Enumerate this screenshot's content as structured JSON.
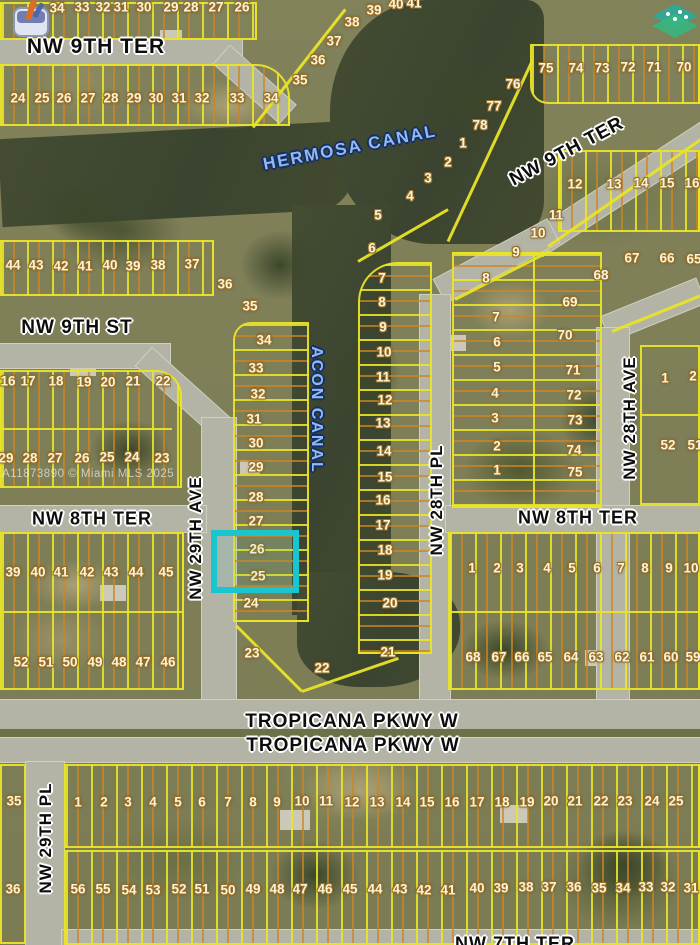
{
  "map": {
    "watermark": "A11873890 © Miami MLS 2025",
    "highlighted_lots": [
      "26",
      "25"
    ],
    "icons": [
      {
        "name": "listing-marker-icon"
      },
      {
        "name": "mls-logo-icon"
      }
    ],
    "street_labels": [
      {
        "text": "NW 9TH TER",
        "x": 96,
        "y": 47,
        "rot": 0,
        "size": 21,
        "canal": false
      },
      {
        "text": "NW 9TH TER",
        "x": 567,
        "y": 152,
        "rot": -28,
        "size": 19,
        "canal": false
      },
      {
        "text": "HERMOSA CANAL",
        "x": 350,
        "y": 148,
        "rot": -11,
        "size": 17,
        "canal": true
      },
      {
        "text": "NW 9TH ST",
        "x": 77,
        "y": 328,
        "rot": 0,
        "size": 19,
        "canal": false
      },
      {
        "text": "ACON CANAL",
        "x": 316,
        "y": 410,
        "rot": 90,
        "size": 16,
        "canal": true
      },
      {
        "text": "NW 29TH AVE",
        "x": 196,
        "y": 538,
        "rot": -90,
        "size": 17,
        "canal": false
      },
      {
        "text": "NW 28TH PL",
        "x": 437,
        "y": 500,
        "rot": -90,
        "size": 17,
        "canal": false
      },
      {
        "text": "NW 28TH AVE",
        "x": 630,
        "y": 418,
        "rot": -90,
        "size": 17,
        "canal": false
      },
      {
        "text": "NW 8TH TER",
        "x": 92,
        "y": 519,
        "rot": 0,
        "size": 18,
        "canal": false
      },
      {
        "text": "NW 8TH TER",
        "x": 578,
        "y": 518,
        "rot": 0,
        "size": 18,
        "canal": false
      },
      {
        "text": "TROPICANA PKWY W",
        "x": 352,
        "y": 722,
        "rot": 0,
        "size": 19,
        "canal": false
      },
      {
        "text": "TROPICANA PKWY W",
        "x": 353,
        "y": 746,
        "rot": 0,
        "size": 19,
        "canal": false
      },
      {
        "text": "NW 29TH PL",
        "x": 46,
        "y": 838,
        "rot": -90,
        "size": 17,
        "canal": false
      },
      {
        "text": "NW 7TH TER",
        "x": 515,
        "y": 944,
        "rot": 0,
        "size": 18,
        "canal": false
      }
    ],
    "lot_numbers": [
      {
        "t": "34",
        "x": 57,
        "y": 8
      },
      {
        "t": "33",
        "x": 82,
        "y": 7
      },
      {
        "t": "32",
        "x": 103,
        "y": 7
      },
      {
        "t": "31",
        "x": 121,
        "y": 7
      },
      {
        "t": "30",
        "x": 144,
        "y": 7
      },
      {
        "t": "29",
        "x": 171,
        "y": 7
      },
      {
        "t": "28",
        "x": 191,
        "y": 7
      },
      {
        "t": "27",
        "x": 216,
        "y": 7
      },
      {
        "t": "26",
        "x": 242,
        "y": 7
      },
      {
        "t": "24",
        "x": 18,
        "y": 98
      },
      {
        "t": "25",
        "x": 42,
        "y": 98
      },
      {
        "t": "26",
        "x": 64,
        "y": 98
      },
      {
        "t": "27",
        "x": 88,
        "y": 98
      },
      {
        "t": "28",
        "x": 111,
        "y": 98
      },
      {
        "t": "29",
        "x": 134,
        "y": 98
      },
      {
        "t": "30",
        "x": 156,
        "y": 98
      },
      {
        "t": "31",
        "x": 179,
        "y": 98
      },
      {
        "t": "32",
        "x": 202,
        "y": 98
      },
      {
        "t": "33",
        "x": 237,
        "y": 98
      },
      {
        "t": "34",
        "x": 271,
        "y": 98
      },
      {
        "t": "35",
        "x": 300,
        "y": 80
      },
      {
        "t": "36",
        "x": 318,
        "y": 60
      },
      {
        "t": "37",
        "x": 334,
        "y": 41
      },
      {
        "t": "38",
        "x": 352,
        "y": 22
      },
      {
        "t": "39",
        "x": 374,
        "y": 10
      },
      {
        "t": "40",
        "x": 396,
        "y": 4
      },
      {
        "t": "41",
        "x": 414,
        "y": 3
      },
      {
        "t": "75",
        "x": 546,
        "y": 68
      },
      {
        "t": "74",
        "x": 576,
        "y": 68
      },
      {
        "t": "73",
        "x": 602,
        "y": 68
      },
      {
        "t": "72",
        "x": 628,
        "y": 67
      },
      {
        "t": "71",
        "x": 654,
        "y": 67
      },
      {
        "t": "70",
        "x": 684,
        "y": 67
      },
      {
        "t": "76",
        "x": 513,
        "y": 84
      },
      {
        "t": "77",
        "x": 494,
        "y": 106
      },
      {
        "t": "78",
        "x": 480,
        "y": 125
      },
      {
        "t": "1",
        "x": 463,
        "y": 143
      },
      {
        "t": "2",
        "x": 448,
        "y": 162
      },
      {
        "t": "3",
        "x": 428,
        "y": 178
      },
      {
        "t": "4",
        "x": 410,
        "y": 196
      },
      {
        "t": "44",
        "x": 13,
        "y": 265
      },
      {
        "t": "43",
        "x": 36,
        "y": 265
      },
      {
        "t": "42",
        "x": 61,
        "y": 266
      },
      {
        "t": "41",
        "x": 85,
        "y": 266
      },
      {
        "t": "40",
        "x": 110,
        "y": 265
      },
      {
        "t": "39",
        "x": 133,
        "y": 266
      },
      {
        "t": "38",
        "x": 158,
        "y": 265
      },
      {
        "t": "37",
        "x": 192,
        "y": 264
      },
      {
        "t": "36",
        "x": 225,
        "y": 284
      },
      {
        "t": "35",
        "x": 250,
        "y": 306
      },
      {
        "t": "16",
        "x": 8,
        "y": 381
      },
      {
        "t": "17",
        "x": 28,
        "y": 381
      },
      {
        "t": "18",
        "x": 56,
        "y": 381
      },
      {
        "t": "19",
        "x": 84,
        "y": 382
      },
      {
        "t": "20",
        "x": 108,
        "y": 382
      },
      {
        "t": "21",
        "x": 133,
        "y": 381
      },
      {
        "t": "22",
        "x": 163,
        "y": 381
      },
      {
        "t": "29",
        "x": 6,
        "y": 458
      },
      {
        "t": "28",
        "x": 30,
        "y": 458
      },
      {
        "t": "27",
        "x": 55,
        "y": 458
      },
      {
        "t": "26",
        "x": 82,
        "y": 458
      },
      {
        "t": "25",
        "x": 107,
        "y": 457
      },
      {
        "t": "24",
        "x": 132,
        "y": 457
      },
      {
        "t": "23",
        "x": 162,
        "y": 458
      },
      {
        "t": "34",
        "x": 264,
        "y": 340
      },
      {
        "t": "33",
        "x": 256,
        "y": 368
      },
      {
        "t": "32",
        "x": 258,
        "y": 394
      },
      {
        "t": "31",
        "x": 254,
        "y": 419
      },
      {
        "t": "30",
        "x": 256,
        "y": 443
      },
      {
        "t": "29",
        "x": 256,
        "y": 467
      },
      {
        "t": "28",
        "x": 256,
        "y": 497
      },
      {
        "t": "27",
        "x": 256,
        "y": 521
      },
      {
        "t": "26",
        "x": 257,
        "y": 549
      },
      {
        "t": "25",
        "x": 258,
        "y": 576
      },
      {
        "t": "24",
        "x": 251,
        "y": 603
      },
      {
        "t": "23",
        "x": 252,
        "y": 653
      },
      {
        "t": "22",
        "x": 322,
        "y": 668
      },
      {
        "t": "5",
        "x": 378,
        "y": 215
      },
      {
        "t": "6",
        "x": 372,
        "y": 248
      },
      {
        "t": "7",
        "x": 382,
        "y": 278
      },
      {
        "t": "8",
        "x": 382,
        "y": 302
      },
      {
        "t": "9",
        "x": 383,
        "y": 327
      },
      {
        "t": "10",
        "x": 384,
        "y": 352
      },
      {
        "t": "11",
        "x": 383,
        "y": 377
      },
      {
        "t": "12",
        "x": 385,
        "y": 400
      },
      {
        "t": "13",
        "x": 383,
        "y": 423
      },
      {
        "t": "14",
        "x": 384,
        "y": 451
      },
      {
        "t": "15",
        "x": 385,
        "y": 477
      },
      {
        "t": "16",
        "x": 383,
        "y": 500
      },
      {
        "t": "17",
        "x": 383,
        "y": 525
      },
      {
        "t": "18",
        "x": 385,
        "y": 550
      },
      {
        "t": "19",
        "x": 385,
        "y": 575
      },
      {
        "t": "20",
        "x": 390,
        "y": 603
      },
      {
        "t": "21",
        "x": 388,
        "y": 652
      },
      {
        "t": "12",
        "x": 575,
        "y": 184
      },
      {
        "t": "13",
        "x": 614,
        "y": 184
      },
      {
        "t": "14",
        "x": 641,
        "y": 183
      },
      {
        "t": "15",
        "x": 667,
        "y": 183
      },
      {
        "t": "16",
        "x": 692,
        "y": 183
      },
      {
        "t": "11",
        "x": 556,
        "y": 215
      },
      {
        "t": "10",
        "x": 538,
        "y": 233
      },
      {
        "t": "9",
        "x": 516,
        "y": 252
      },
      {
        "t": "8",
        "x": 486,
        "y": 278
      },
      {
        "t": "7",
        "x": 496,
        "y": 317
      },
      {
        "t": "6",
        "x": 497,
        "y": 342
      },
      {
        "t": "5",
        "x": 497,
        "y": 367
      },
      {
        "t": "4",
        "x": 495,
        "y": 393
      },
      {
        "t": "3",
        "x": 495,
        "y": 418
      },
      {
        "t": "2",
        "x": 497,
        "y": 446
      },
      {
        "t": "1",
        "x": 497,
        "y": 470
      },
      {
        "t": "67",
        "x": 632,
        "y": 258
      },
      {
        "t": "66",
        "x": 667,
        "y": 258
      },
      {
        "t": "65",
        "x": 694,
        "y": 259
      },
      {
        "t": "68",
        "x": 601,
        "y": 275
      },
      {
        "t": "69",
        "x": 570,
        "y": 302
      },
      {
        "t": "70",
        "x": 565,
        "y": 335
      },
      {
        "t": "71",
        "x": 573,
        "y": 370
      },
      {
        "t": "72",
        "x": 574,
        "y": 395
      },
      {
        "t": "73",
        "x": 575,
        "y": 420
      },
      {
        "t": "74",
        "x": 574,
        "y": 450
      },
      {
        "t": "75",
        "x": 575,
        "y": 472
      },
      {
        "t": "1",
        "x": 665,
        "y": 378
      },
      {
        "t": "2",
        "x": 693,
        "y": 376
      },
      {
        "t": "52",
        "x": 668,
        "y": 445
      },
      {
        "t": "51",
        "x": 695,
        "y": 445
      },
      {
        "t": "1",
        "x": 472,
        "y": 568
      },
      {
        "t": "2",
        "x": 497,
        "y": 568
      },
      {
        "t": "3",
        "x": 520,
        "y": 568
      },
      {
        "t": "4",
        "x": 547,
        "y": 568
      },
      {
        "t": "5",
        "x": 572,
        "y": 568
      },
      {
        "t": "6",
        "x": 597,
        "y": 568
      },
      {
        "t": "7",
        "x": 621,
        "y": 568
      },
      {
        "t": "8",
        "x": 645,
        "y": 568
      },
      {
        "t": "9",
        "x": 669,
        "y": 568
      },
      {
        "t": "10",
        "x": 691,
        "y": 568
      },
      {
        "t": "68",
        "x": 473,
        "y": 657
      },
      {
        "t": "67",
        "x": 499,
        "y": 657
      },
      {
        "t": "66",
        "x": 522,
        "y": 657
      },
      {
        "t": "65",
        "x": 545,
        "y": 657
      },
      {
        "t": "64",
        "x": 571,
        "y": 657
      },
      {
        "t": "63",
        "x": 596,
        "y": 657
      },
      {
        "t": "62",
        "x": 622,
        "y": 657
      },
      {
        "t": "61",
        "x": 647,
        "y": 657
      },
      {
        "t": "60",
        "x": 671,
        "y": 657
      },
      {
        "t": "59",
        "x": 693,
        "y": 657
      },
      {
        "t": "39",
        "x": 13,
        "y": 572
      },
      {
        "t": "40",
        "x": 38,
        "y": 572
      },
      {
        "t": "41",
        "x": 61,
        "y": 572
      },
      {
        "t": "42",
        "x": 87,
        "y": 572
      },
      {
        "t": "43",
        "x": 111,
        "y": 572
      },
      {
        "t": "44",
        "x": 136,
        "y": 572
      },
      {
        "t": "45",
        "x": 166,
        "y": 572
      },
      {
        "t": "52",
        "x": 21,
        "y": 662
      },
      {
        "t": "51",
        "x": 46,
        "y": 662
      },
      {
        "t": "50",
        "x": 70,
        "y": 662
      },
      {
        "t": "49",
        "x": 95,
        "y": 662
      },
      {
        "t": "48",
        "x": 119,
        "y": 662
      },
      {
        "t": "47",
        "x": 143,
        "y": 662
      },
      {
        "t": "46",
        "x": 168,
        "y": 662
      },
      {
        "t": "35",
        "x": 14,
        "y": 801
      },
      {
        "t": "36",
        "x": 13,
        "y": 889
      },
      {
        "t": "1",
        "x": 78,
        "y": 802
      },
      {
        "t": "2",
        "x": 104,
        "y": 802
      },
      {
        "t": "3",
        "x": 128,
        "y": 802
      },
      {
        "t": "4",
        "x": 153,
        "y": 802
      },
      {
        "t": "5",
        "x": 178,
        "y": 802
      },
      {
        "t": "6",
        "x": 202,
        "y": 802
      },
      {
        "t": "7",
        "x": 228,
        "y": 802
      },
      {
        "t": "8",
        "x": 253,
        "y": 802
      },
      {
        "t": "9",
        "x": 277,
        "y": 802
      },
      {
        "t": "10",
        "x": 302,
        "y": 801
      },
      {
        "t": "11",
        "x": 326,
        "y": 801
      },
      {
        "t": "12",
        "x": 352,
        "y": 802
      },
      {
        "t": "13",
        "x": 377,
        "y": 802
      },
      {
        "t": "14",
        "x": 403,
        "y": 802
      },
      {
        "t": "15",
        "x": 427,
        "y": 802
      },
      {
        "t": "16",
        "x": 452,
        "y": 802
      },
      {
        "t": "17",
        "x": 477,
        "y": 802
      },
      {
        "t": "18",
        "x": 502,
        "y": 802
      },
      {
        "t": "19",
        "x": 527,
        "y": 802
      },
      {
        "t": "20",
        "x": 551,
        "y": 801
      },
      {
        "t": "21",
        "x": 575,
        "y": 801
      },
      {
        "t": "22",
        "x": 601,
        "y": 801
      },
      {
        "t": "23",
        "x": 625,
        "y": 801
      },
      {
        "t": "24",
        "x": 652,
        "y": 801
      },
      {
        "t": "25",
        "x": 676,
        "y": 801
      },
      {
        "t": "56",
        "x": 78,
        "y": 889
      },
      {
        "t": "55",
        "x": 103,
        "y": 889
      },
      {
        "t": "54",
        "x": 129,
        "y": 890
      },
      {
        "t": "53",
        "x": 153,
        "y": 890
      },
      {
        "t": "52",
        "x": 179,
        "y": 889
      },
      {
        "t": "51",
        "x": 202,
        "y": 889
      },
      {
        "t": "50",
        "x": 228,
        "y": 890
      },
      {
        "t": "49",
        "x": 253,
        "y": 889
      },
      {
        "t": "48",
        "x": 277,
        "y": 889
      },
      {
        "t": "47",
        "x": 300,
        "y": 889
      },
      {
        "t": "46",
        "x": 325,
        "y": 889
      },
      {
        "t": "45",
        "x": 350,
        "y": 889
      },
      {
        "t": "44",
        "x": 375,
        "y": 889
      },
      {
        "t": "43",
        "x": 400,
        "y": 889
      },
      {
        "t": "42",
        "x": 424,
        "y": 890
      },
      {
        "t": "41",
        "x": 448,
        "y": 890
      },
      {
        "t": "40",
        "x": 477,
        "y": 888
      },
      {
        "t": "39",
        "x": 501,
        "y": 888
      },
      {
        "t": "38",
        "x": 526,
        "y": 887
      },
      {
        "t": "37",
        "x": 549,
        "y": 887
      },
      {
        "t": "36",
        "x": 574,
        "y": 887
      },
      {
        "t": "35",
        "x": 599,
        "y": 888
      },
      {
        "t": "34",
        "x": 623,
        "y": 888
      },
      {
        "t": "33",
        "x": 646,
        "y": 887
      },
      {
        "t": "32",
        "x": 668,
        "y": 887
      },
      {
        "t": "31",
        "x": 691,
        "y": 888
      }
    ]
  }
}
